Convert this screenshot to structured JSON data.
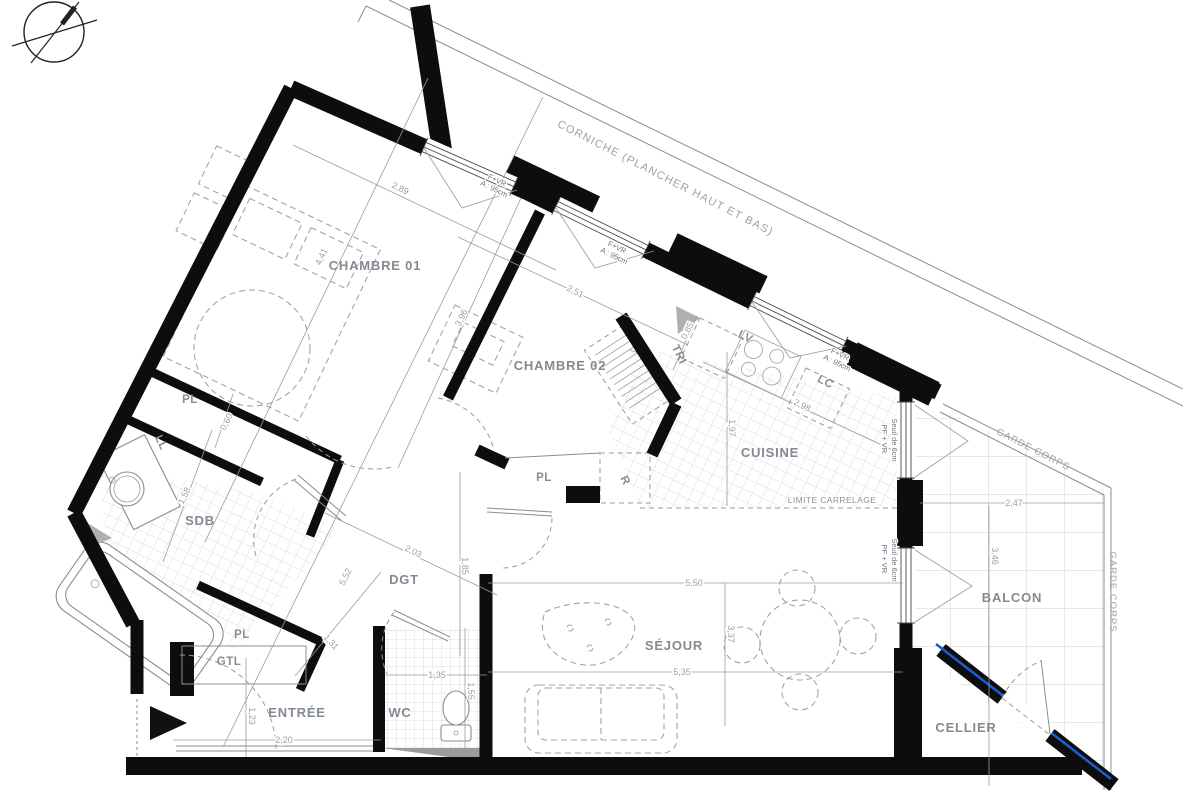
{
  "plan": {
    "rooms": {
      "chambre01": "CHAMBRE 01",
      "chambre02": "CHAMBRE 02",
      "cuisine": "CUISINE",
      "sdb": "SDB",
      "dgt": "DGT",
      "sejour": "SÉJOUR",
      "entree": "ENTRÉE",
      "wc": "WC",
      "cellier": "CELLIER",
      "balcon": "BALCON"
    },
    "closets": {
      "pl": "PL",
      "gtl": "GTL",
      "ll": "LL",
      "tri": "TRI",
      "r": "R",
      "lv": "LV",
      "lc": "LC"
    },
    "annotations": {
      "corniche": "CORNICHE (PLANCHER HAUT ET BAS)",
      "window_type": "F+VR",
      "window_height": "A : 95cm",
      "door_window_type": "PF + VR",
      "door_window_sill": "Seuil de 6cm",
      "tile_limit": "LIMITE CARRELAGE",
      "railing": "GARDE CORPS"
    },
    "dimensions": {
      "d289": "2,89",
      "d441": "4,41",
      "d251": "2,51",
      "d396": "3,96",
      "d085": "0,85",
      "d298": "2,98",
      "d197": "1,97",
      "d060": "0,60",
      "d158": "1,58",
      "d203": "2,03",
      "d185": "1,85",
      "d552": "5,52",
      "d550": "5,50",
      "d337": "3,37",
      "d535": "5,35",
      "d247": "2,47",
      "d346": "3,46",
      "d135": "1,35",
      "d155": "1,55",
      "d220": "2,20",
      "d123": "1,23",
      "d131": "1,31"
    },
    "colors": {
      "wall": "#0d0d0d",
      "accent_blue": "#1a5fd0",
      "label_gray": "#848a93",
      "dim_gray": "#9aa2ac"
    }
  }
}
